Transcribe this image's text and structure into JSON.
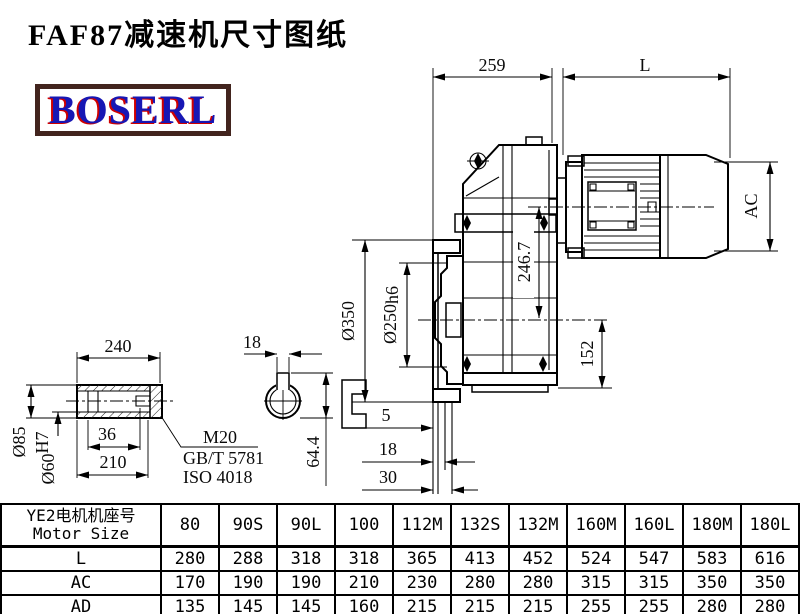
{
  "title": "FAF87减速机尺寸图纸",
  "logo": {
    "text": "BOSERL",
    "text_color": "#1717b4",
    "shadow_color": "#cf0000",
    "border_color": "#42241e"
  },
  "main_view": {
    "dims": {
      "d259": "259",
      "dL": "L",
      "dAC": "AC",
      "d246": "246.7",
      "d350": "Ø350",
      "d250_base": "Ø250",
      "d250_tol": "h6",
      "d152": "152",
      "d5": "5",
      "d18": "18",
      "d30": "30"
    }
  },
  "shaft_view": {
    "dims": {
      "d240": "240",
      "d85": "Ø85",
      "d60_base": "Ø60",
      "d60_tol": "H7",
      "d36": "36",
      "d210": "210",
      "d18key": "18",
      "d64": "64.4"
    },
    "callout": {
      "thread": "M20",
      "std1": "GB/T 5781",
      "std2": "ISO 4018"
    }
  },
  "table": {
    "header_cn": "YE2电机机座号",
    "header_en": "Motor Size",
    "columns": [
      "80",
      "90S",
      "90L",
      "100",
      "112M",
      "132S",
      "132M",
      "160M",
      "160L",
      "180M",
      "180L"
    ],
    "rows": [
      {
        "label": "L",
        "values": [
          "280",
          "288",
          "318",
          "318",
          "365",
          "413",
          "452",
          "524",
          "547",
          "583",
          "616"
        ]
      },
      {
        "label": "AC",
        "values": [
          "170",
          "190",
          "190",
          "210",
          "230",
          "280",
          "280",
          "315",
          "315",
          "350",
          "350"
        ]
      },
      {
        "label": "AD",
        "values": [
          "135",
          "145",
          "145",
          "160",
          "215",
          "215",
          "215",
          "255",
          "255",
          "280",
          "280"
        ]
      }
    ]
  }
}
